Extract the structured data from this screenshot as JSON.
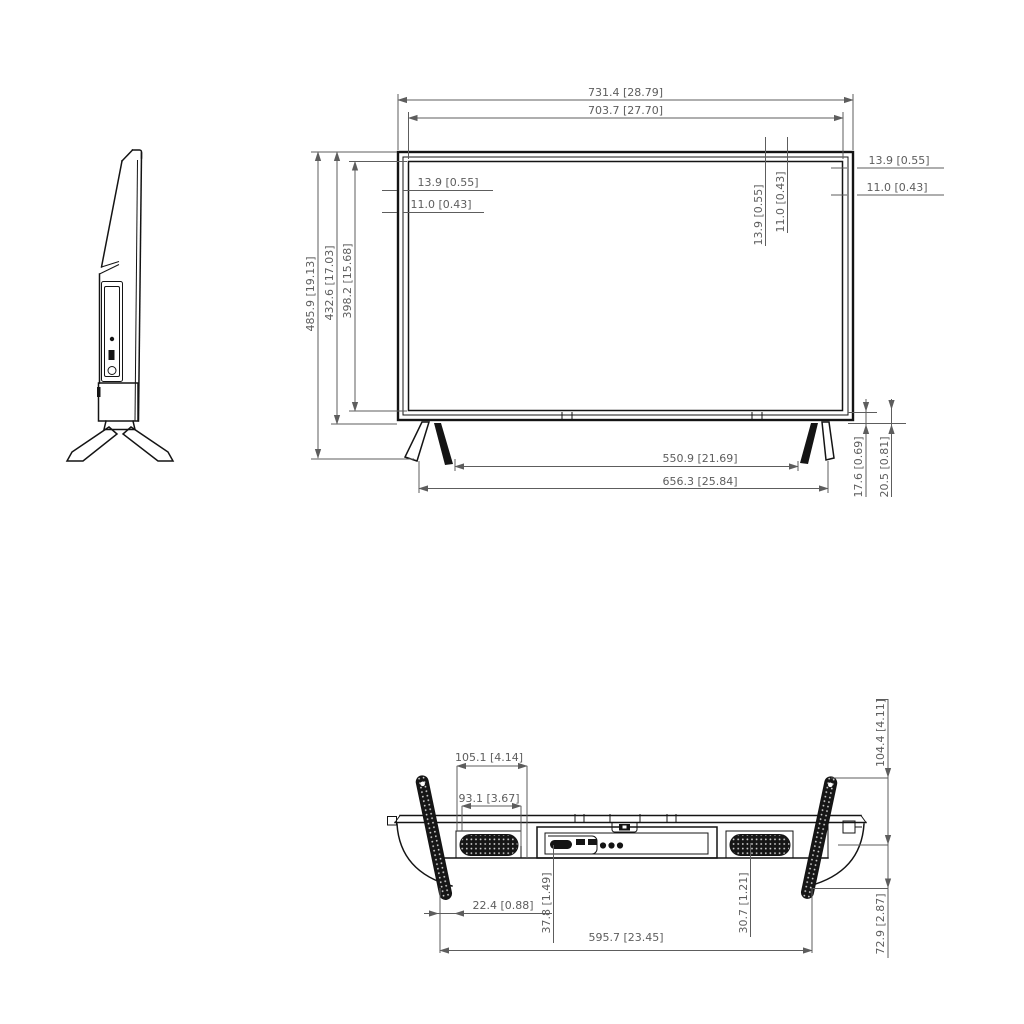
{
  "drawing": {
    "type": "tv-monitor-dimension-drawing",
    "units": "mm [inch]",
    "colors": {
      "object_line": "#141414",
      "dimension_line": "#5d5d5d",
      "background": "#ffffff"
    }
  },
  "front": {
    "width_total": "731.4 [28.79]",
    "width_screen": "703.7 [27.70]",
    "height_total": "485.9 [19.13]",
    "height_body": "432.6 [17.03]",
    "height_screen": "398.2 [15.68]",
    "bezel_left_a": "13.9 [0.55]",
    "bezel_left_b": "11.0 [0.43]",
    "bezel_mid_a": "13.9 [0.55]",
    "bezel_mid_b": "11.0 [0.43]",
    "bezel_right_a": "13.9 [0.55]",
    "bezel_right_b": "11.0 [0.43]",
    "feet_inner_span": "550.9 [21.69]",
    "feet_outer_span": "656.3 [25.84]",
    "foot_h_a": "17.6 [0.69]",
    "foot_h_b": "20.5 [0.81]"
  },
  "bottom": {
    "speaker_a": "105.1 [4.14]",
    "speaker_b": "93.1 [3.67]",
    "depth_with_stand": "104.4 [4.11]",
    "offset_a": "22.4 [0.88]",
    "offset_b": "37.8 [1.49]",
    "feet_span": "595.7 [23.45]",
    "offset_c": "30.7 [1.21]",
    "stand_depth": "72.9 [2.87]"
  }
}
